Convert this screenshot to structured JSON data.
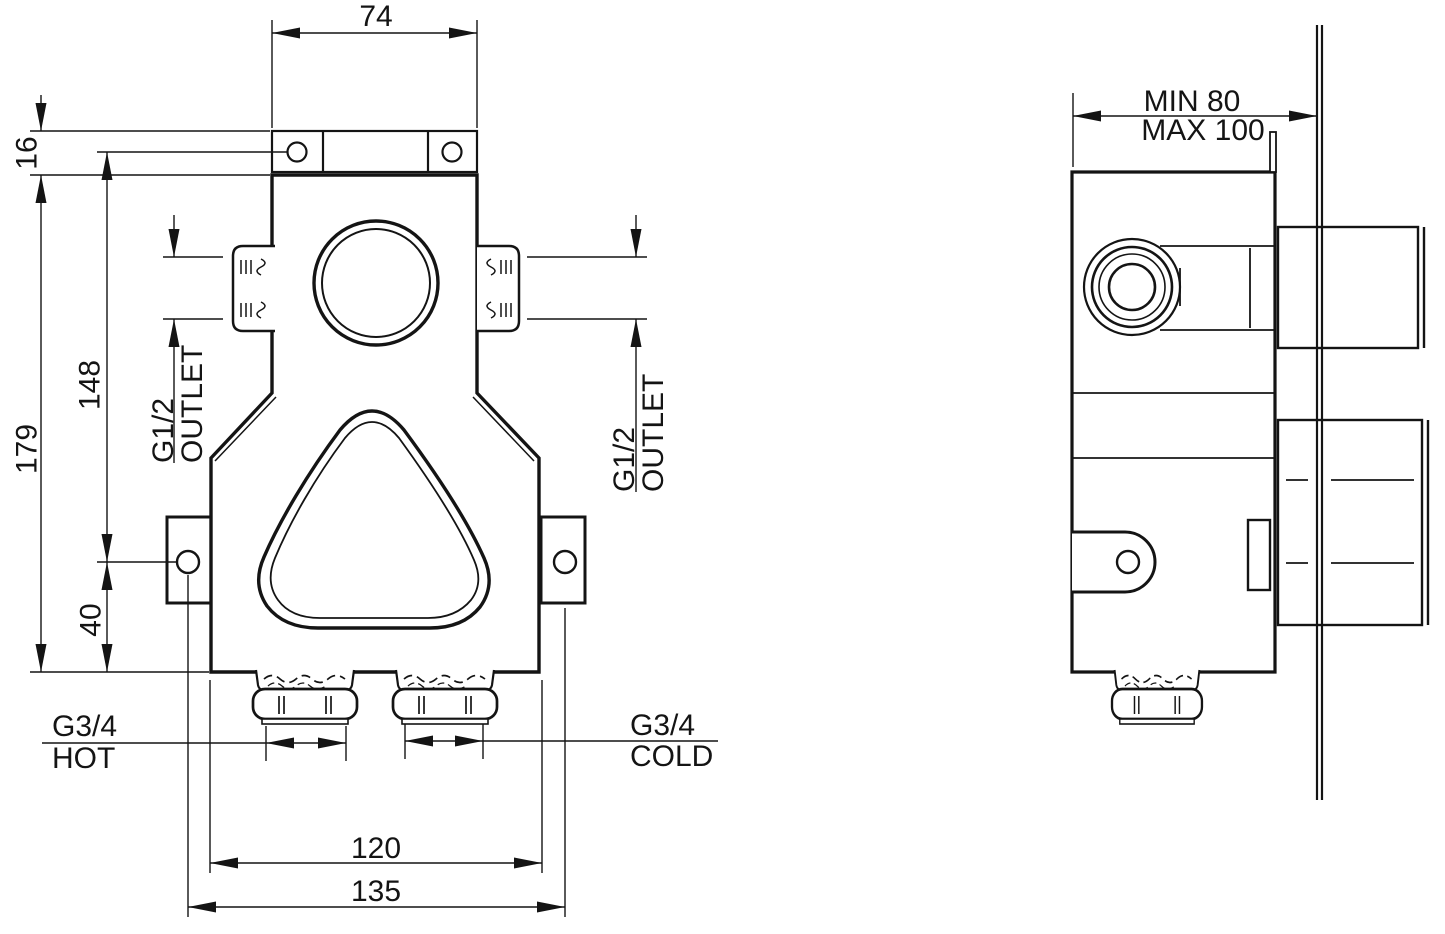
{
  "front_view": {
    "dim_top_width": "74",
    "dim_flange_offset": "16",
    "dim_total_height": "179",
    "dim_outlet_height": "148",
    "dim_tab_to_bottom": "40",
    "dim_body_width": "120",
    "dim_fixing_span": "135",
    "outlet_left": {
      "thread": "G1/2",
      "label": "OUTLET"
    },
    "outlet_right": {
      "thread": "G1/2",
      "label": "OUTLET"
    },
    "inlet_hot": {
      "thread": "G3/4",
      "label": "HOT"
    },
    "inlet_cold": {
      "thread": "G3/4",
      "label": "COLD"
    }
  },
  "side_view": {
    "dim_depth_min": "MIN 80",
    "dim_depth_max": "MAX 100"
  },
  "colors": {
    "line": "#141414",
    "background": "#ffffff"
  }
}
